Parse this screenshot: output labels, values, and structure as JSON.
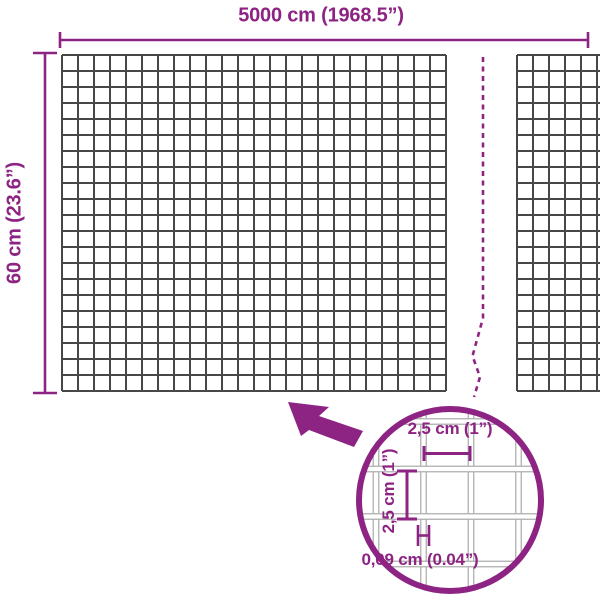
{
  "diagram": {
    "width_label": "5000 cm (1968.5”)",
    "height_label": "60 cm (23.6”)",
    "detail": {
      "cell_width_label": "2,5 cm (1”)",
      "cell_height_label": "2,5 cm (1”)",
      "wire_thickness_label": "0,09 cm (0.04”)"
    },
    "colors": {
      "accent": "#8d2383",
      "mesh_line": "#474747",
      "detail_wire_outline": "#b0b0b0",
      "detail_wire_fill": "#ffffff",
      "background": "#ffffff"
    }
  }
}
